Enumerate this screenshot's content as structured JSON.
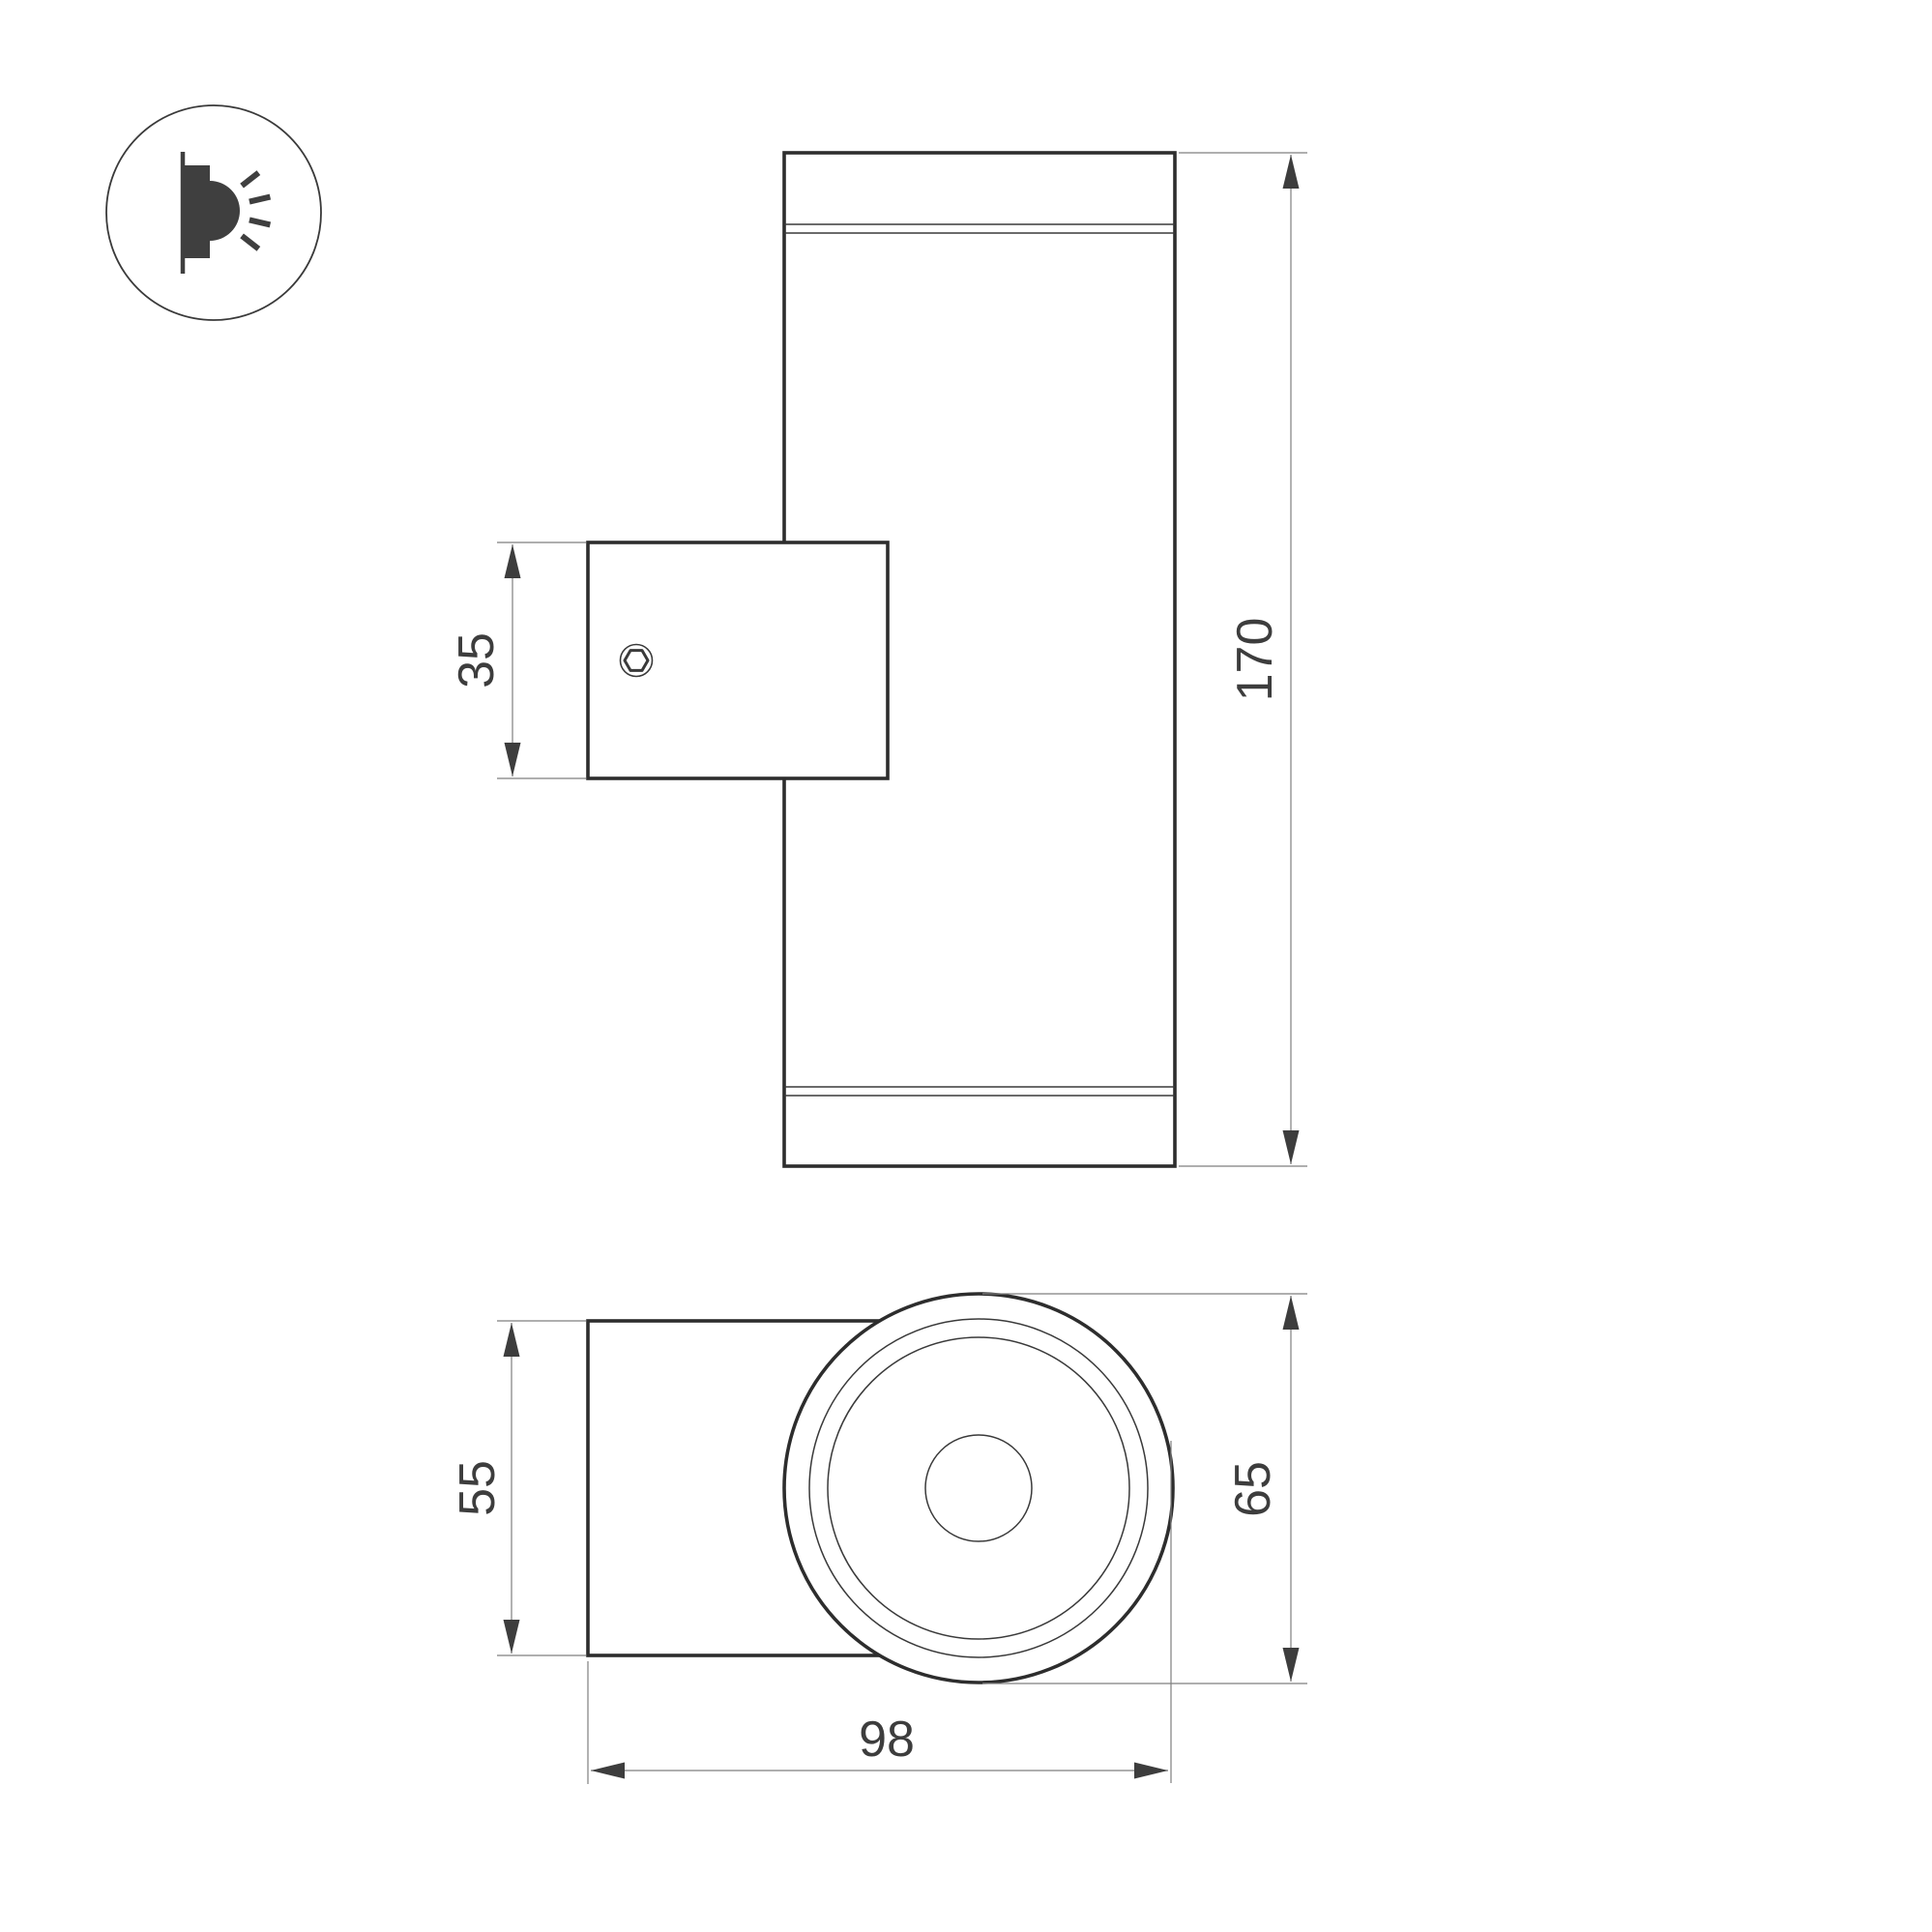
{
  "drawing": {
    "title": "wall-lamp-technical-drawing",
    "icon": {
      "name": "surface-wall-light-icon"
    },
    "dimensions": {
      "bracket_height": "35",
      "body_height": "170",
      "mount_width": "55",
      "body_diameter": "65",
      "total_depth": "98"
    },
    "colors": {
      "outline_bold": "#2d2d2d",
      "outline_thin": "#3a3a3a",
      "dimension_line": "#7f7f7f",
      "arrow_and_text": "#3d3d3d",
      "background": "#ffffff"
    }
  }
}
